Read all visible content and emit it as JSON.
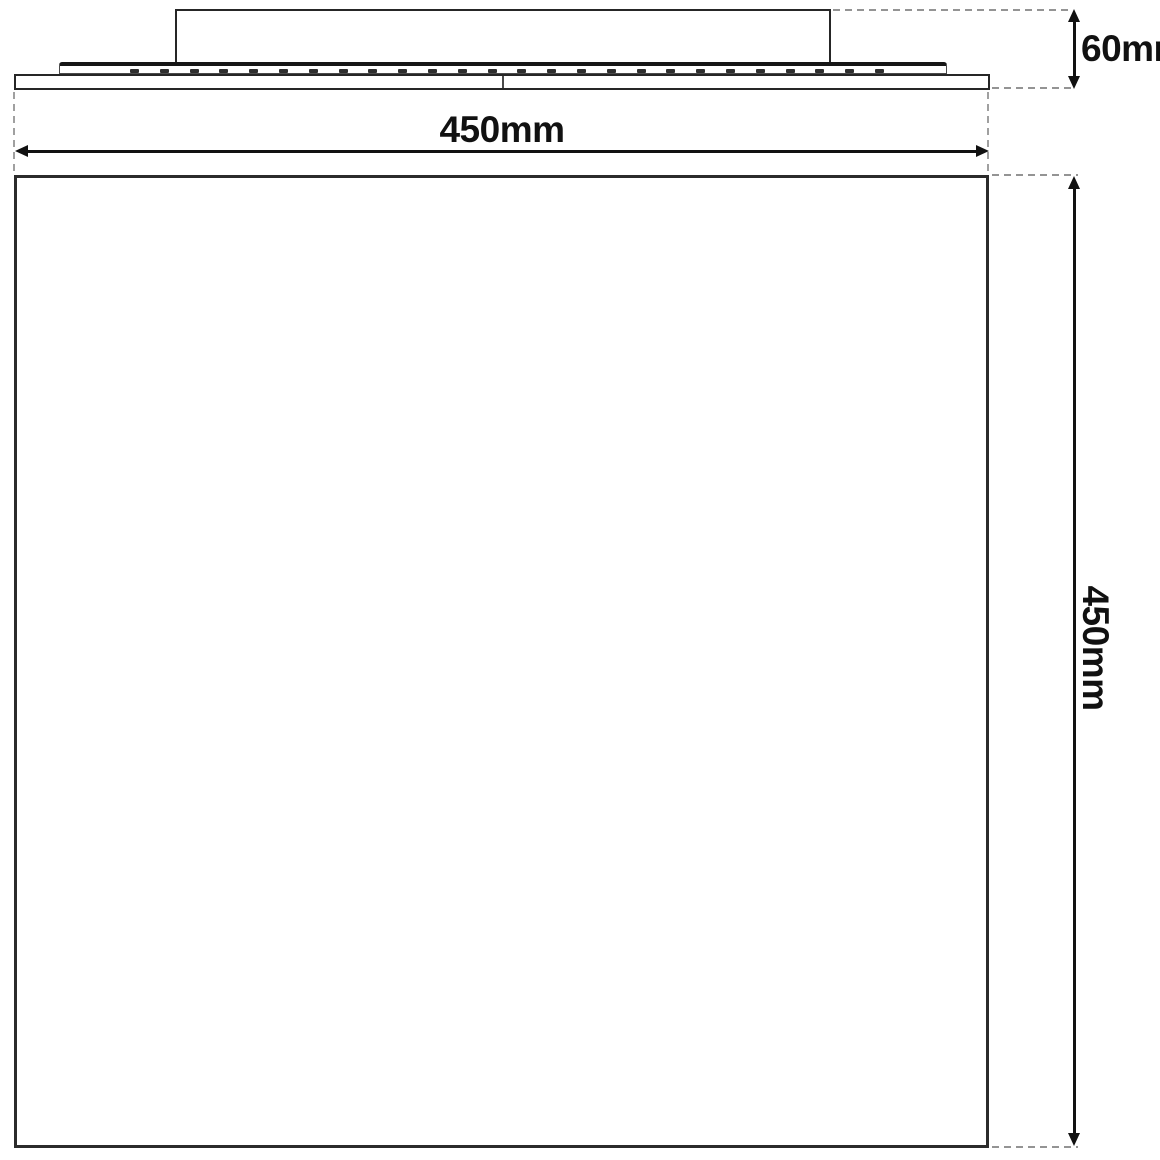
{
  "drawing": {
    "kind": "technical-dimension-drawing",
    "subject": "square-panel-ceiling-light",
    "colors": {
      "background": "#ffffff",
      "line": "#262626",
      "dimension": "#111111",
      "extension_dash": "#949494"
    },
    "views": {
      "side_view": {
        "parts": [
          "driver-box",
          "back-plate",
          "led-ticks",
          "panel-frame"
        ],
        "led_tick_count": 26,
        "led_tick_spacing_px": 29.8
      },
      "front_view": {
        "parts": [
          "panel-face"
        ]
      }
    },
    "dimensions": {
      "fixture_height": {
        "label": "60mm"
      },
      "panel_width": {
        "label": "450mm"
      },
      "panel_height": {
        "label": "450mm"
      }
    }
  }
}
